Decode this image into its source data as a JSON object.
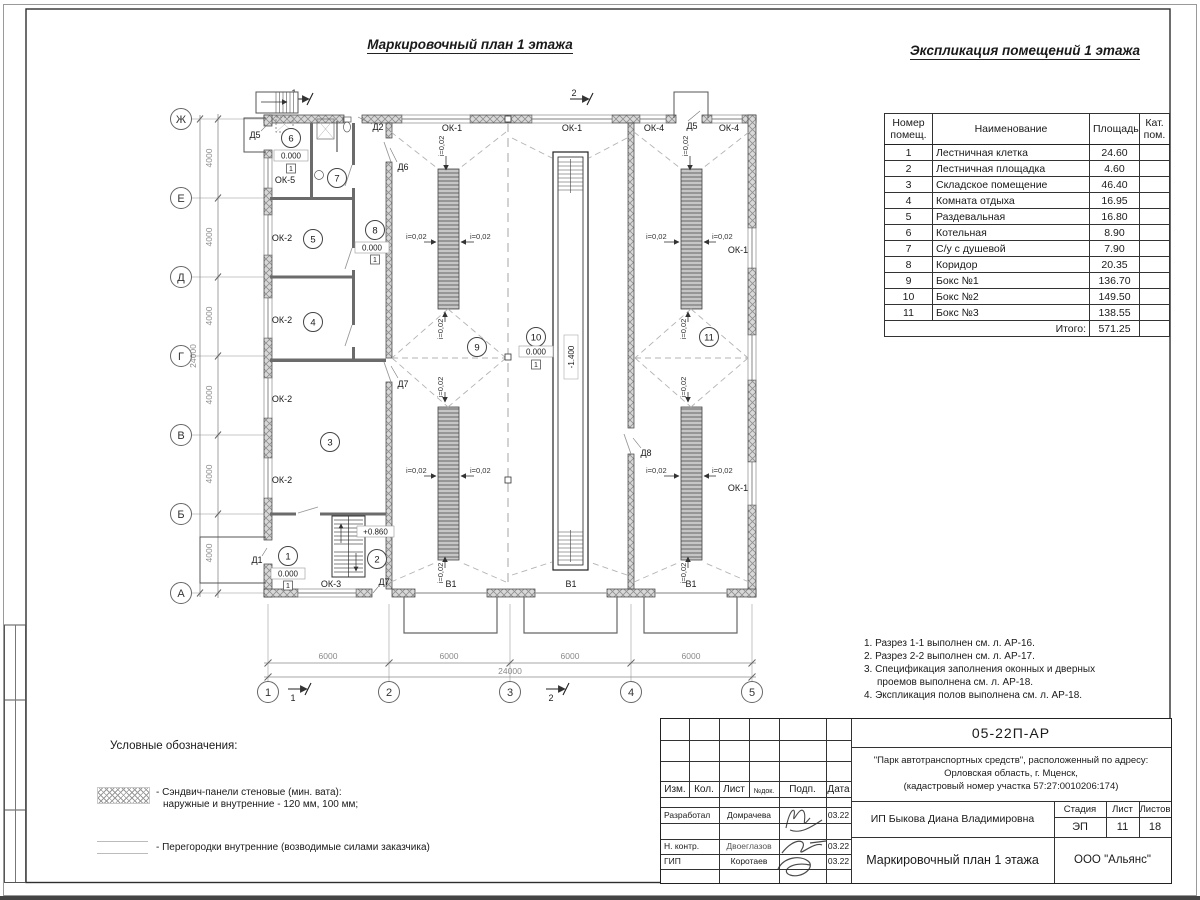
{
  "titles": {
    "plan": "Маркировочный план 1 этажа",
    "explication": "Экспликация помещений 1 этажа"
  },
  "explication": {
    "headers": {
      "num": "Номер помещ.",
      "name": "Наименование",
      "area": "Площадь",
      "cat": "Кат. пом."
    },
    "rows": [
      {
        "num": "1",
        "name": "Лестничная клетка",
        "area": "24.60",
        "cat": ""
      },
      {
        "num": "2",
        "name": "Лестничная площадка",
        "area": "4.60",
        "cat": ""
      },
      {
        "num": "3",
        "name": "Складское помещение",
        "area": "46.40",
        "cat": ""
      },
      {
        "num": "4",
        "name": "Комната отдыха",
        "area": "16.95",
        "cat": ""
      },
      {
        "num": "5",
        "name": "Раздевальная",
        "area": "16.80",
        "cat": ""
      },
      {
        "num": "6",
        "name": "Котельная",
        "area": "8.90",
        "cat": ""
      },
      {
        "num": "7",
        "name": "С/у с душевой",
        "area": "7.90",
        "cat": ""
      },
      {
        "num": "8",
        "name": "Коридор",
        "area": "20.35",
        "cat": ""
      },
      {
        "num": "9",
        "name": "Бокс №1",
        "area": "136.70",
        "cat": ""
      },
      {
        "num": "10",
        "name": "Бокс №2",
        "area": "149.50",
        "cat": ""
      },
      {
        "num": "11",
        "name": "Бокс №3",
        "area": "138.55",
        "cat": ""
      }
    ],
    "total_label": "Итого:",
    "total": "571.25"
  },
  "notes": {
    "n1": "1. Разрез 1-1 выполнен см. л. АР-16.",
    "n2": "2. Разрез 2-2 выполнен см. л. АР-17.",
    "n3": "3. Спецификация заполнения оконных и дверных",
    "n3b": "проемов выполнена см. л. АР-18.",
    "n4": "4. Экспликация полов выполнена см. л. АР-18."
  },
  "legend": {
    "title": "Условные обозначения:",
    "item1_line1": "- Сэндвич-панели стеновые (мин. вата):",
    "item1_line2": "наружные и внутренние - 120 мм, 100 мм;",
    "item2": "- Перегородки внутренние (возводимые силами заказчика)"
  },
  "stamp": {
    "doc_number": "05-22П-АР",
    "project_line1": "\"Парк автотранспортных средств\",  расположенный по адресу:",
    "project_line2": "Орловская область, г. Мценск,",
    "project_line3": "(кадастровый номер участка 57:27:0010206:174)",
    "cols": {
      "izm": "Изм.",
      "kol": "Кол.",
      "list": "Лист",
      "ndok": "№док.",
      "podp": "Подп.",
      "data": "Дата"
    },
    "rows": {
      "developed_label": "Разработал",
      "developed_name": "Домрачева",
      "developed_date": "03.22",
      "ncontr_label": "Н. контр.",
      "ncontr_name": "Двоеглазов",
      "ncontr_date": "03.22",
      "gip_label": "ГИП",
      "gip_name": "Коротаев",
      "gip_date": "03.22"
    },
    "client": "ИП Быкова Диана Владимировна",
    "stage_label": "Стадия",
    "sheet_label": "Лист",
    "sheets_label": "Листов",
    "stage": "ЭП",
    "sheet": "11",
    "sheets": "18",
    "drawing_title": "Маркировочный план 1 этажа",
    "company": "ООО \"Альянс\""
  },
  "plan": {
    "axes": {
      "letters": [
        "Ж",
        "Е",
        "Д",
        "Г",
        "В",
        "Б",
        "А"
      ],
      "numbers": [
        "1",
        "2",
        "3",
        "4",
        "5"
      ]
    },
    "dims": {
      "d4000": "4000",
      "d24000": "24000",
      "d6000": "6000"
    },
    "rooms": [
      "1",
      "2",
      "3",
      "4",
      "5",
      "6",
      "7",
      "8",
      "9",
      "10",
      "11"
    ],
    "labels": {
      "ok1": "ОК-1",
      "ok2": "ОК-2",
      "ok3": "ОК-3",
      "ok4": "ОК-4",
      "ok5": "ОК-5",
      "d1": "Д1",
      "d2": "Д2",
      "d5": "Д5",
      "d6": "Д6",
      "d7": "Д7",
      "d8": "Д8",
      "v1": "В1",
      "slope": "i=0,02",
      "elev_zero": "0.000",
      "elev_landing": "+0.860",
      "elev_pit": "-1.400",
      "floor_type": "1",
      "section1": "1",
      "section2": "2"
    }
  }
}
